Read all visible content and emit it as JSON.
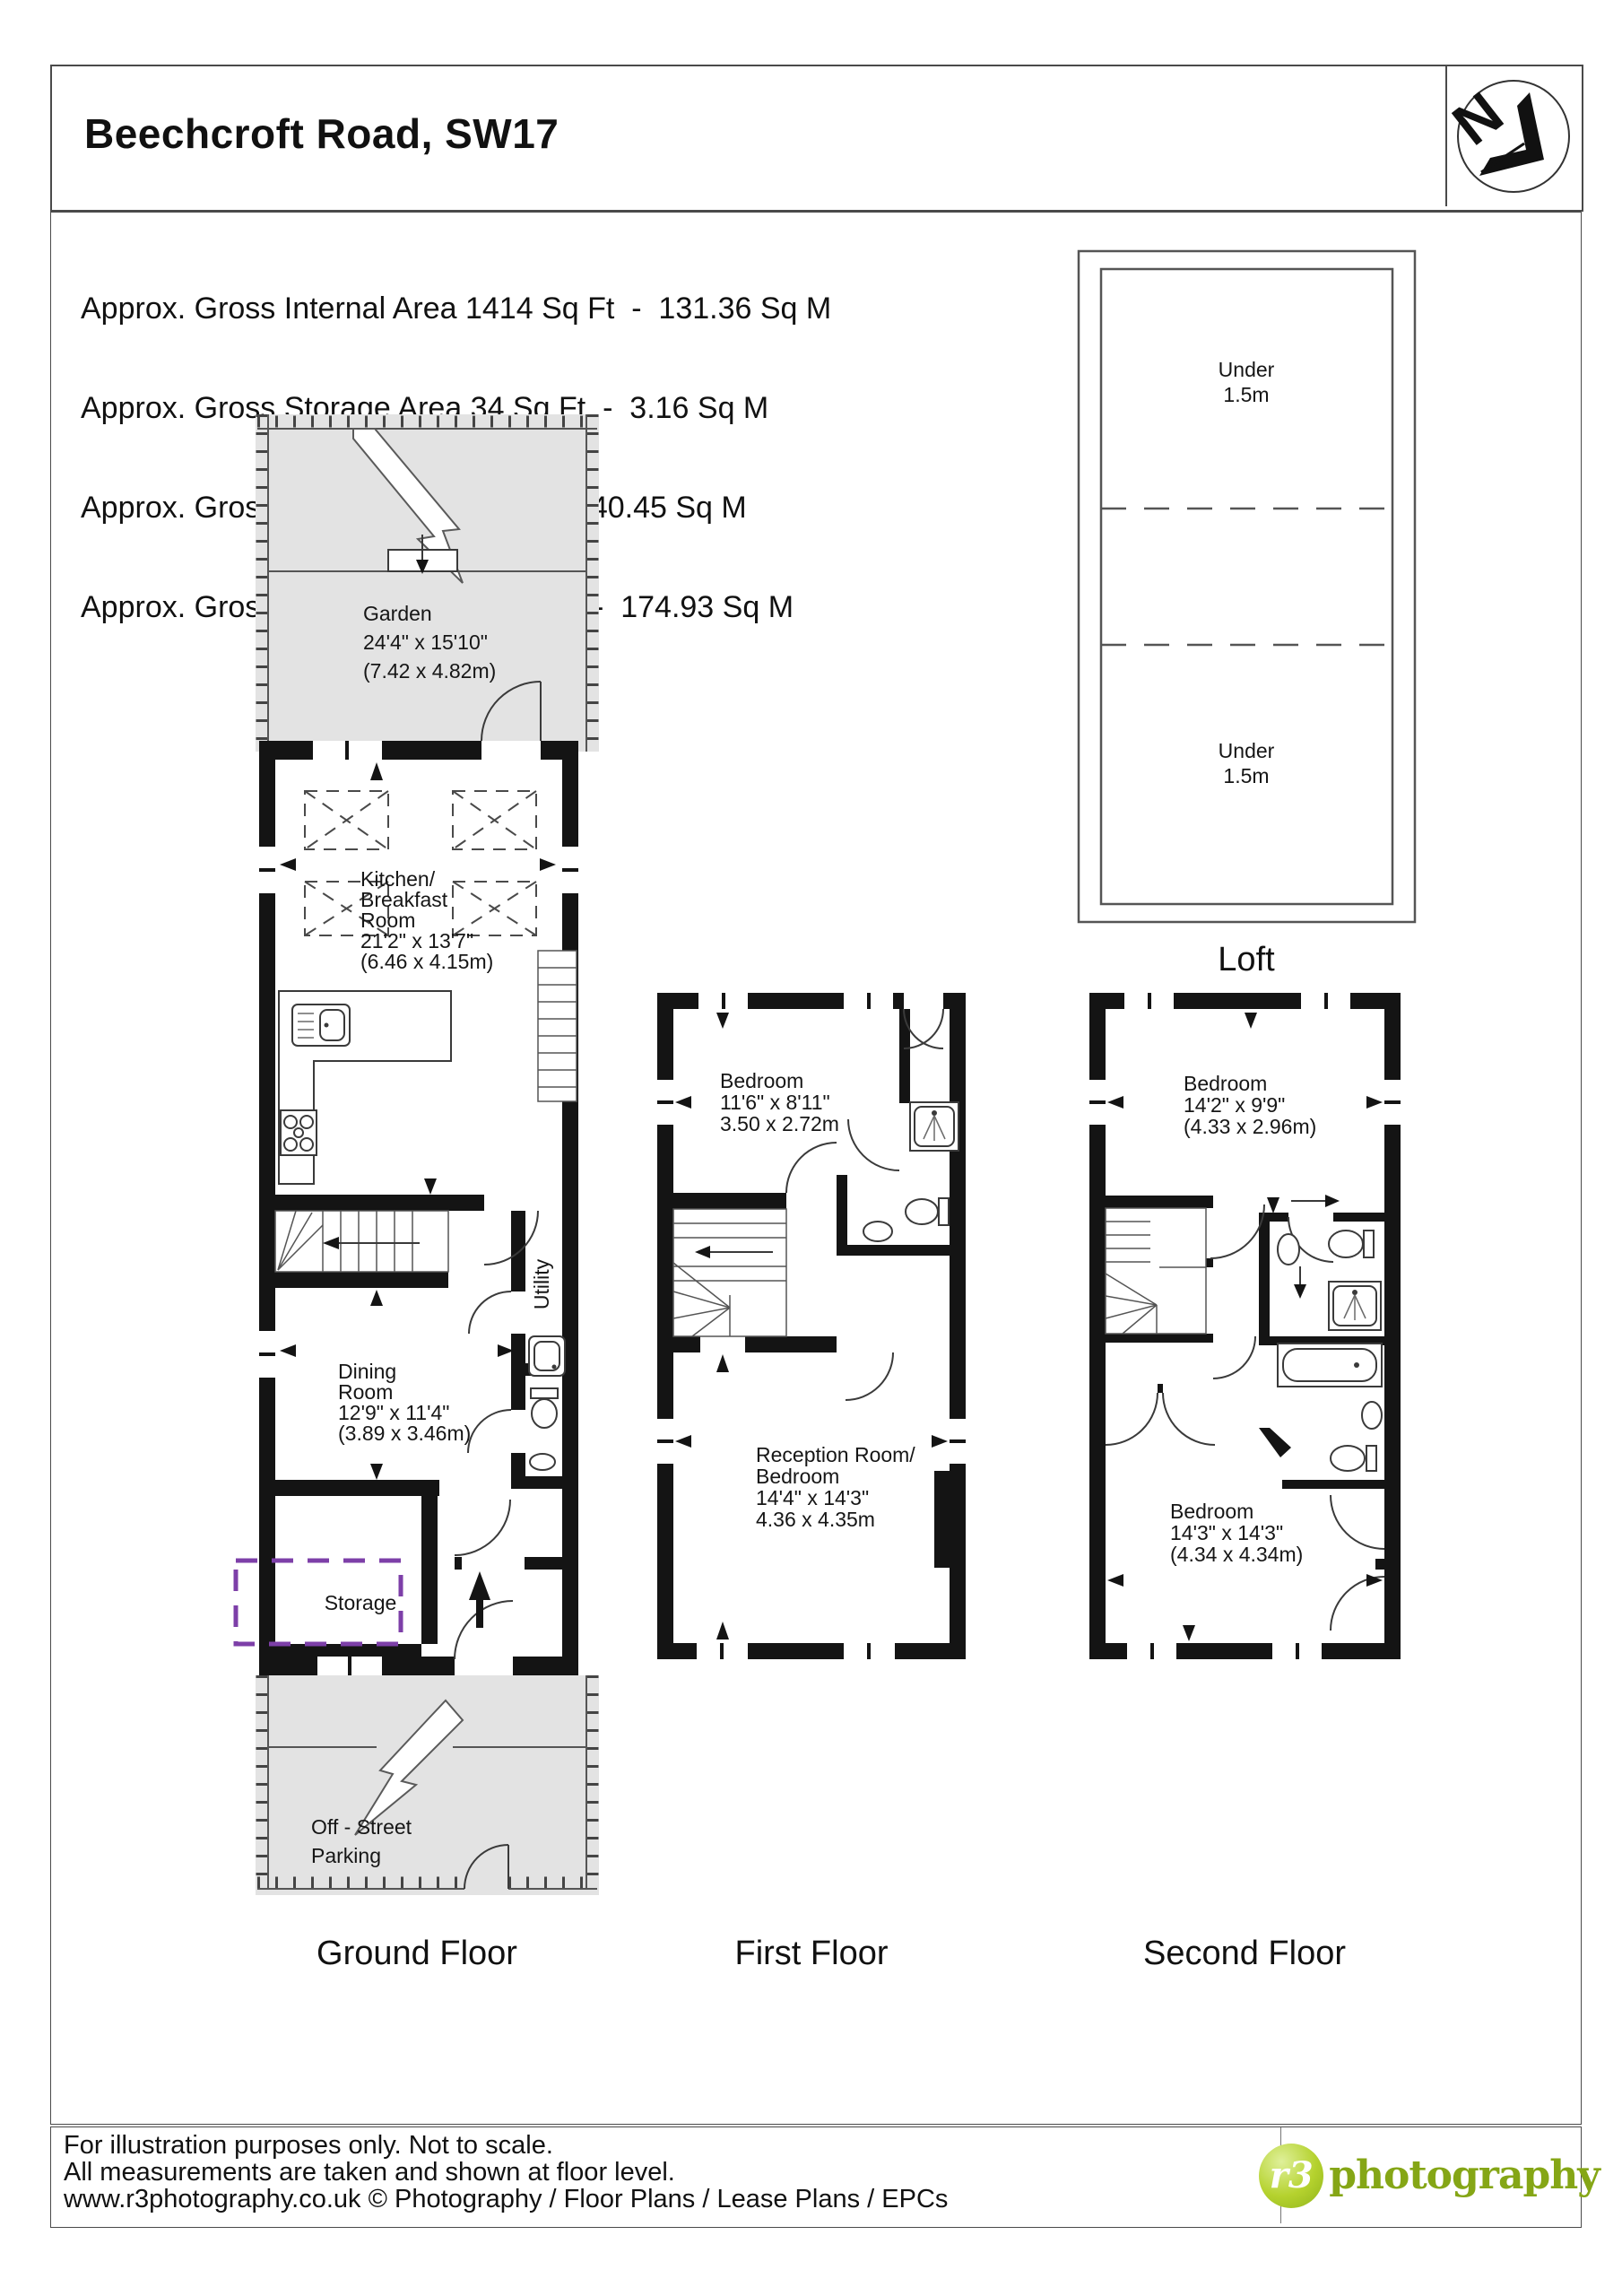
{
  "header": {
    "title": "Beechcroft Road, SW17",
    "north_letter": "N"
  },
  "area_summary": {
    "line1": "Approx. Gross Internal Area 1414 Sq Ft  -  131.36 Sq M",
    "line2": "Approx. Gross Storage Area 34 Sq Ft  -  3.16 Sq M",
    "line3": "Approx. Gross Loft Area 435 Sq Ft  -  40.45 Sq M",
    "line4": "Approx. Gross Total Area 1883 Sq Ft  -  174.93 Sq M"
  },
  "loft": {
    "label": "Loft",
    "under_top_1": "Under",
    "under_top_2": "1.5m",
    "under_bottom_1": "Under",
    "under_bottom_2": "1.5m"
  },
  "ground": {
    "label": "Ground Floor",
    "garden": {
      "name": "Garden",
      "dims_ft": "24'4\" x 15'10\"",
      "dims_m": "(7.42 x 4.82m)"
    },
    "kitchen": {
      "l1": "Kitchen/",
      "l2": "Breakfast",
      "l3": "Room",
      "dims_ft": "21'2\" x 13'7\"",
      "dims_m": "(6.46 x 4.15m)"
    },
    "dining": {
      "l1": "Dining",
      "l2": "Room",
      "dims_ft": "12'9\" x 11'4\"",
      "dims_m": "(3.89 x 3.46m)"
    },
    "utility": "Utility",
    "storage": "Storage",
    "parking": {
      "l1": "Off - Street",
      "l2": "Parking"
    }
  },
  "first": {
    "label": "First Floor",
    "bedroom": {
      "name": "Bedroom",
      "dims_ft": "11'6\" x 8'11\"",
      "dims_m": "3.50 x 2.72m"
    },
    "reception": {
      "l1": "Reception Room/",
      "l2": "Bedroom",
      "dims_ft": "14'4\" x 14'3\"",
      "dims_m": "4.36 x 4.35m"
    }
  },
  "second": {
    "label": "Second Floor",
    "bedroom_front": {
      "name": "Bedroom",
      "dims_ft": "14'2\" x 9'9\"",
      "dims_m": "(4.33 x 2.96m)"
    },
    "bedroom_back": {
      "name": "Bedroom",
      "dims_ft": "14'3\" x 14'3\"",
      "dims_m": "(4.34 x 4.34m)"
    }
  },
  "footer": {
    "line1": "For illustration purposes only. Not to scale.",
    "line2": "All measurements are taken and shown at floor level.",
    "line3": "www.r3photography.co.uk © Photography / Floor Plans / Lease Plans / EPCs",
    "logo": {
      "mark": "r3",
      "wordmark": "photography"
    }
  },
  "colors": {
    "wall": "#141414",
    "garden_fill": "#e3e3e3",
    "storage_dash": "#7d3fa8",
    "logo_green": "#85a616"
  }
}
